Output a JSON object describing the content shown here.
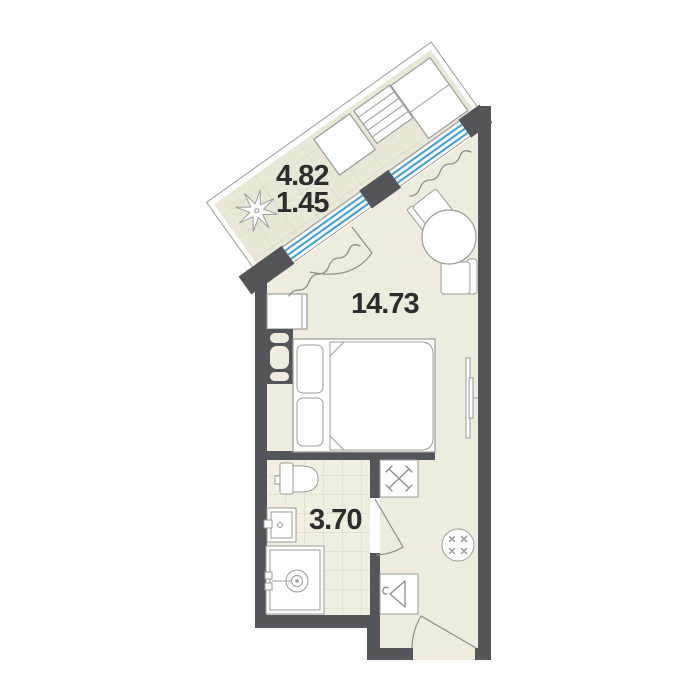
{
  "plan": {
    "kind": "studio apartment floor plan",
    "rooms": {
      "balcony": {
        "area": "4.82",
        "area_reduced": "1.45"
      },
      "living_room": {
        "area": "14.73"
      },
      "bathroom": {
        "area": "3.70"
      }
    },
    "symbols": {
      "plant": "plant-icon",
      "window_glazing": "triple-blue-line-window",
      "curtain": "wavy-curtain-line",
      "ventilation_box": "crossed-x-box-icon",
      "wardrobe_box": "hanger-icon",
      "round_marker": "four-cross-circle-icon",
      "shower": "shower-head-icon",
      "doors": "door-swing-arc"
    }
  },
  "colors": {
    "bg": "#ffffff",
    "wall": "#54555b",
    "floor": "#efecdd",
    "floor_bath": "#f2efe1",
    "floor_balcony": "#ebe7d6",
    "tile": "#d9d5c4",
    "glass": "#3f9ed6",
    "line": "#9b9b98",
    "arc": "#8f8f88",
    "text": "#2d2d2e"
  }
}
